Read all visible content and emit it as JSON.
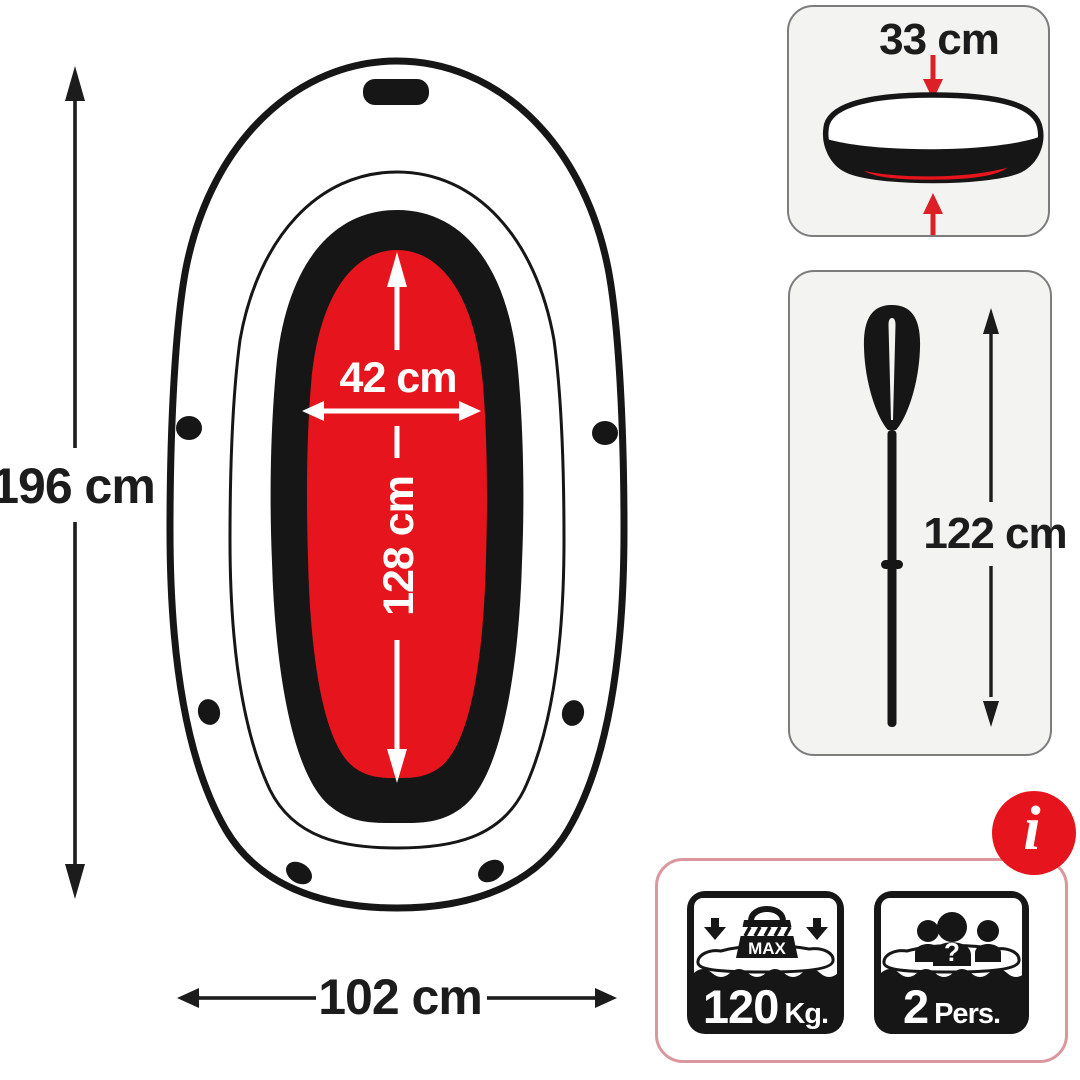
{
  "boat": {
    "length_label": "196 cm",
    "beam_label": "102 cm",
    "cockpit_width_label": "42 cm",
    "cockpit_length_label": "128 cm"
  },
  "side_view_panel": {
    "tube_height_label": "33 cm"
  },
  "oar_panel": {
    "oar_length_label": "122 cm"
  },
  "spec_panel": {
    "max_weight": {
      "icon_label": "MAX",
      "value": "120",
      "unit": "Kg."
    },
    "capacity": {
      "question_mark": "?",
      "value": "2",
      "unit": "Pers."
    },
    "info_symbol": "i"
  },
  "colors": {
    "red": "#e6141c",
    "arrow_red": "#dc2026",
    "ink": "#161616",
    "panel_bg": "#f3f3f1",
    "panel_border": "#7c7c7c",
    "spec_border": "#da979e",
    "white": "#ffffff"
  }
}
